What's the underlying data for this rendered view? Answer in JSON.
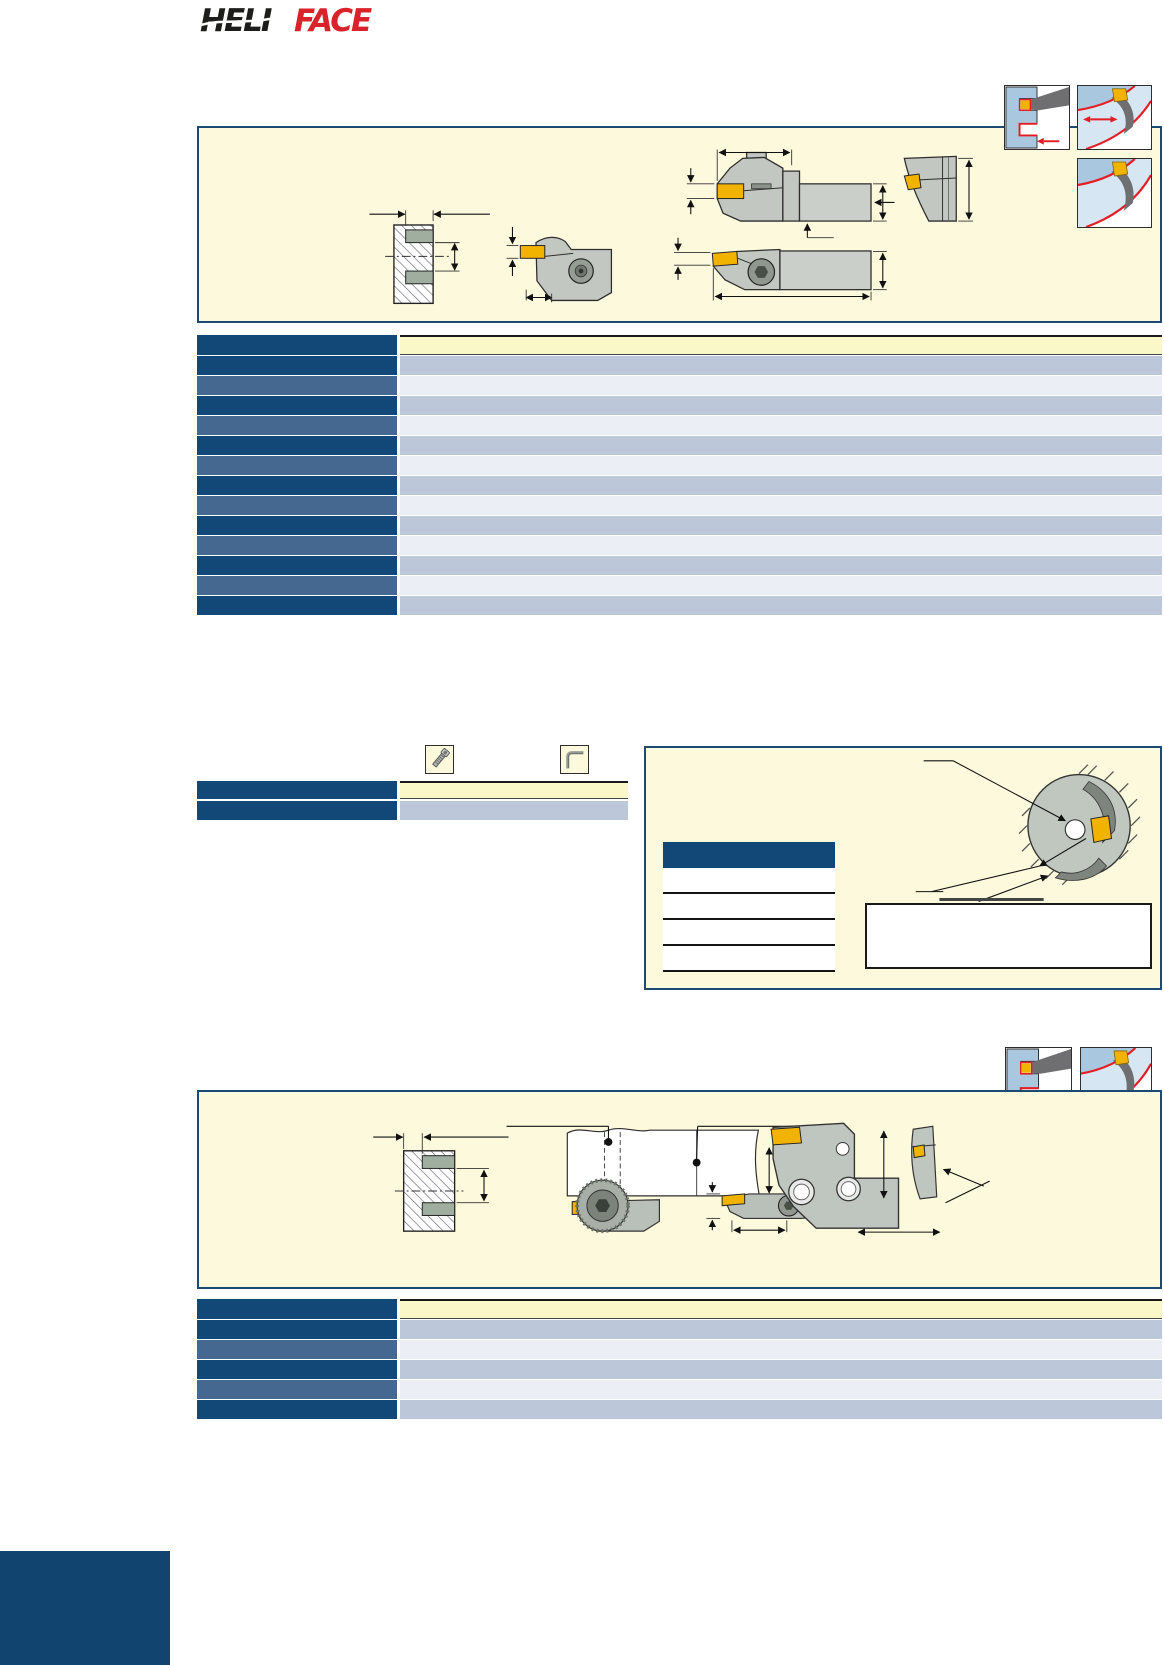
{
  "page": {
    "width": 1164,
    "height": 1665,
    "background": "#ffffff"
  },
  "brand": {
    "logo_part1": "HELI",
    "logo_part2": "FACE",
    "part1_color": "#1d1d1b",
    "part2_color": "#d8232a"
  },
  "palette": {
    "panel_border": "#1b4a74",
    "panel_background": "#fcf9dc",
    "header_navy": "#114878",
    "row_steel": "#44688f",
    "row_blue": "#bcc8da",
    "row_light": "#eceef5",
    "header_cream": "#faf7c8",
    "insert_yellow": "#f2b200",
    "accent_red": "#e31e24",
    "tool_gray": "#c3c7c1",
    "footer_navy": "#11446e"
  },
  "icons": {
    "app_cross_section": "face-groove-cross-section-icon",
    "app_insert_curve": "curved-insert-application-icon",
    "app_axial_feed": "axial-feed-application-icon",
    "screw": "clamp-screw-icon",
    "hex_key": "hex-key-icon"
  },
  "tables": {
    "main": {
      "header": {
        "left": "dark",
        "right": "cream"
      },
      "rows": [
        {
          "left": "dark",
          "right": "blue"
        },
        {
          "left": "steel",
          "right": "light"
        },
        {
          "left": "dark",
          "right": "blue"
        },
        {
          "left": "steel",
          "right": "light"
        },
        {
          "left": "dark",
          "right": "blue"
        },
        {
          "left": "steel",
          "right": "light"
        },
        {
          "left": "dark",
          "right": "blue"
        },
        {
          "left": "steel",
          "right": "light"
        },
        {
          "left": "dark",
          "right": "blue"
        },
        {
          "left": "steel",
          "right": "light"
        },
        {
          "left": "dark",
          "right": "blue"
        },
        {
          "left": "steel",
          "right": "light"
        },
        {
          "left": "dark",
          "right": "blue"
        }
      ]
    },
    "mini": {
      "header": {
        "left": "dark",
        "right": "cream"
      },
      "rows": [
        {
          "left": "dark",
          "right": "blue"
        }
      ]
    },
    "panel_inner": {
      "rows": [
        {
          "fill": "white"
        },
        {
          "fill": "white"
        },
        {
          "fill": "white"
        },
        {
          "fill": "white"
        }
      ]
    },
    "bottom": {
      "header": {
        "left": "dark",
        "right": "cream"
      },
      "rows": [
        {
          "left": "dark",
          "right": "blue"
        },
        {
          "left": "steel",
          "right": "light"
        },
        {
          "left": "dark",
          "right": "blue"
        },
        {
          "left": "steel",
          "right": "light"
        },
        {
          "left": "dark",
          "right": "blue"
        }
      ]
    }
  },
  "annotation_box": {
    "text": ""
  }
}
